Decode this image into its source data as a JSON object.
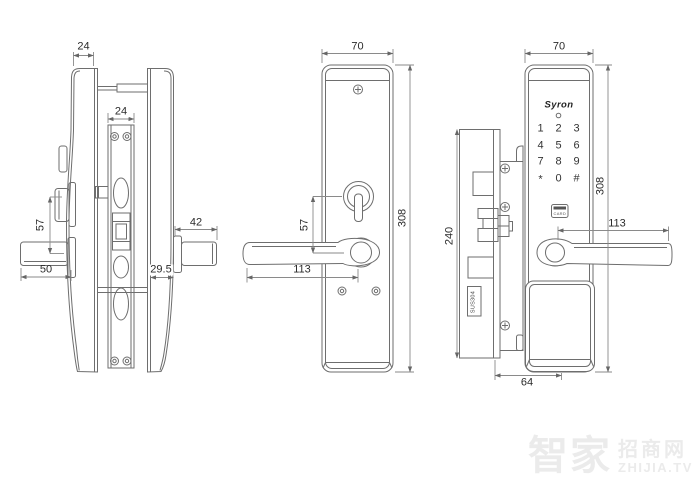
{
  "views": {
    "side": {
      "dims": {
        "top_width": "24",
        "faceplate_width": "24",
        "turn_to_handle": "57",
        "handle_depth": "50",
        "exterior_handle_depth": "42",
        "panel_thickness": "29.5"
      }
    },
    "interior": {
      "dims": {
        "width": "70",
        "height": "308",
        "turn_to_handle": "57",
        "handle_length": "113"
      }
    },
    "exterior": {
      "brand": "Syron",
      "card_label": "CARD",
      "faceplate_material": "SUS304",
      "keypad_keys": [
        "1",
        "2",
        "3",
        "4",
        "5",
        "6",
        "7",
        "8",
        "9",
        "*",
        "0",
        "#"
      ],
      "dims": {
        "width": "70",
        "height": "308",
        "handle_length": "113",
        "lock_body_height": "240",
        "body_width": "64"
      }
    }
  },
  "watermark": {
    "cn_main": "智家",
    "cn_sub": "招商网",
    "site": "ZHIJIA.TV"
  },
  "colors": {
    "background": "#ffffff",
    "line": "#6e6e6e",
    "dim_line": "#8a8a8a",
    "text": "#2b2b2b",
    "watermark": "#ebebeb",
    "card_slot": "#555555"
  }
}
